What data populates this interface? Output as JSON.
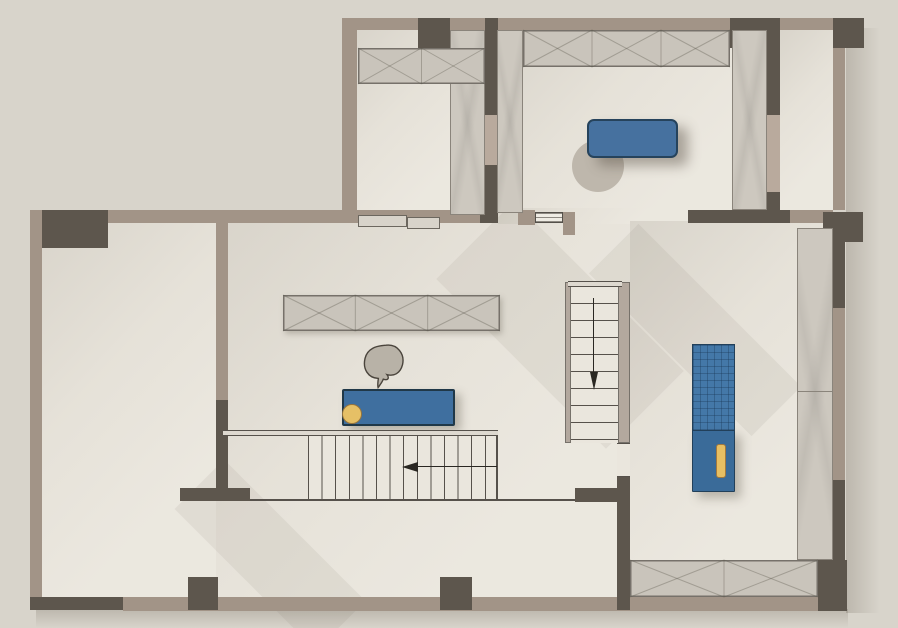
{
  "scene": {
    "kind": "architectural-floor-plan",
    "width": 898,
    "height": 628
  },
  "palette": {
    "bg": "#d8d4cb",
    "floor": "#eae6dd",
    "floorGrad": "linear-gradient(133deg, rgba(92,84,71,0.12), rgba(92,84,71,0.03) 38%, rgba(255,255,255,0.07) 75%)",
    "wallTan": "#a29487",
    "wallTanLight": "#b9aa9d",
    "wallDark": "#5d564d",
    "cabGray": "#c9c4bb",
    "cabBorder": "#76716a",
    "grainGray": "#cdc8bf",
    "grainBorder": "#8a847b",
    "railGray": "#b3a89e",
    "line": "#56514b",
    "xline": "rgba(90,85,75,0.35)",
    "bedBlue": "#46719f",
    "deskBlue": "#3f6f9f",
    "beltBlue": "#4478a8",
    "consoleBlue": "#3a6b99",
    "blueBorder": "#22405a",
    "stoolYellow": "#e6c066",
    "stoolBorder": "#97743c",
    "chairGray": "#b8b2a7",
    "chairBorder": "#4a443c",
    "shadowSoft": "rgba(100,90,76,0.08)",
    "outerShadow": "rgba(105,96,83,0.25)"
  },
  "elements": [
    {
      "name": "outer-shadow-right",
      "type": "shadegrad",
      "x": 846,
      "y": 28,
      "w": 34,
      "h": 585,
      "dir": "to right",
      "inter": false
    },
    {
      "name": "outer-shadow-bottom",
      "type": "shadegrad",
      "x": 36,
      "y": 609,
      "w": 812,
      "h": 19,
      "dir": "to bottom",
      "inter": false
    },
    {
      "name": "floor-cloakroom",
      "type": "floor",
      "x": 357,
      "y": 28,
      "w": 128,
      "h": 184,
      "inter": false
    },
    {
      "name": "floor-bedroom",
      "type": "floor",
      "x": 498,
      "y": 30,
      "w": 269,
      "h": 182,
      "inter": false
    },
    {
      "name": "floor-balcony",
      "type": "floor",
      "x": 780,
      "y": 30,
      "w": 53,
      "h": 182,
      "inter": false
    },
    {
      "name": "floor-left-room",
      "type": "floor",
      "x": 42,
      "y": 221,
      "w": 174,
      "h": 377,
      "inter": false
    },
    {
      "name": "floor-living-area",
      "type": "floor",
      "x": 216,
      "y": 223,
      "w": 414,
      "h": 374,
      "inter": false
    },
    {
      "name": "floor-hall-opening",
      "type": "floor",
      "x": 498,
      "y": 208,
      "w": 190,
      "h": 16,
      "inter": false
    },
    {
      "name": "floor-gym",
      "type": "floor",
      "x": 630,
      "y": 221,
      "w": 203,
      "h": 339,
      "inter": false
    },
    {
      "name": "light-shadow-hall",
      "type": "shade",
      "x": 505,
      "y": 205,
      "w": 110,
      "h": 240,
      "rot": -45,
      "inter": false
    },
    {
      "name": "light-shadow-gym",
      "type": "shade",
      "x": 660,
      "y": 215,
      "w": 70,
      "h": 230,
      "rot": -45,
      "inter": false
    },
    {
      "name": "light-shadow-foyer",
      "type": "shade",
      "x": 235,
      "y": 455,
      "w": 70,
      "h": 200,
      "rot": -45,
      "inter": false
    },
    {
      "name": "wall-top-upper",
      "type": "wall",
      "x": 347,
      "y": 18,
      "w": 488,
      "h": 12,
      "fill": "tan",
      "inter": false
    },
    {
      "name": "wall-upper-left",
      "type": "wall",
      "x": 342,
      "y": 18,
      "w": 15,
      "h": 197,
      "fill": "tan",
      "inter": false
    },
    {
      "name": "column-cloak-top",
      "type": "wall",
      "x": 418,
      "y": 18,
      "w": 32,
      "h": 30,
      "fill": "dark",
      "inter": false
    },
    {
      "name": "wall-cloak-bedroom-upper",
      "type": "wall",
      "x": 485,
      "y": 18,
      "w": 13,
      "h": 97,
      "fill": "dark",
      "inter": false
    },
    {
      "name": "door-cloak-bedroom",
      "type": "wall",
      "x": 485,
      "y": 115,
      "w": 13,
      "h": 50,
      "fill": "tanlight",
      "inter": true
    },
    {
      "name": "wall-cloak-bedroom-lower",
      "type": "wall",
      "x": 485,
      "y": 165,
      "w": 13,
      "h": 53,
      "fill": "dark",
      "inter": false
    },
    {
      "name": "column-bedroom-top",
      "type": "wall",
      "x": 730,
      "y": 18,
      "w": 50,
      "h": 30,
      "fill": "dark",
      "inter": false
    },
    {
      "name": "column-corner-ne",
      "type": "wall",
      "x": 833,
      "y": 18,
      "w": 31,
      "h": 30,
      "fill": "dark",
      "inter": false
    },
    {
      "name": "wall-right-upper",
      "type": "wall",
      "x": 833,
      "y": 48,
      "w": 12,
      "h": 162,
      "fill": "tan",
      "inter": false
    },
    {
      "name": "wall-bedroom-balcony-upper",
      "type": "wall",
      "x": 767,
      "y": 48,
      "w": 13,
      "h": 67,
      "fill": "dark",
      "inter": false
    },
    {
      "name": "door-bedroom-balcony",
      "type": "wall",
      "x": 767,
      "y": 115,
      "w": 13,
      "h": 77,
      "fill": "tanlight",
      "inter": true
    },
    {
      "name": "wall-bedroom-balcony-lower",
      "type": "wall",
      "x": 767,
      "y": 192,
      "w": 13,
      "h": 20,
      "fill": "dark",
      "inter": false
    },
    {
      "name": "wall-bedroom-bottom-dark",
      "type": "wall",
      "x": 688,
      "y": 210,
      "w": 102,
      "h": 13,
      "fill": "dark",
      "inter": false
    },
    {
      "name": "wall-bedroom-bottom-tan",
      "type": "wall",
      "x": 790,
      "y": 210,
      "w": 43,
      "h": 13,
      "fill": "tan",
      "inter": false
    },
    {
      "name": "column-corner-e",
      "type": "wall",
      "x": 823,
      "y": 212,
      "w": 40,
      "h": 30,
      "fill": "dark",
      "inter": false
    },
    {
      "name": "wall-right-mid-dark",
      "type": "wall",
      "x": 833,
      "y": 242,
      "w": 12,
      "h": 66,
      "fill": "dark",
      "inter": false
    },
    {
      "name": "wall-right-mid-tan",
      "type": "wall",
      "x": 833,
      "y": 308,
      "w": 12,
      "h": 172,
      "fill": "tan",
      "inter": false
    },
    {
      "name": "wall-right-low-dark",
      "type": "wall",
      "x": 833,
      "y": 480,
      "w": 12,
      "h": 131,
      "fill": "dark",
      "inter": false
    },
    {
      "name": "wall-top-lower",
      "type": "wall",
      "x": 30,
      "y": 210,
      "w": 317,
      "h": 13,
      "fill": "tan",
      "inter": false
    },
    {
      "name": "column-corner-nw",
      "type": "wall",
      "x": 30,
      "y": 210,
      "w": 78,
      "h": 38,
      "fill": "dark",
      "inter": false
    },
    {
      "name": "wall-left",
      "type": "wall",
      "x": 30,
      "y": 210,
      "w": 12,
      "h": 400,
      "fill": "tan",
      "inter": false
    },
    {
      "name": "wall-bottom-dark",
      "type": "wall",
      "x": 30,
      "y": 597,
      "w": 93,
      "h": 13,
      "fill": "dark",
      "inter": false
    },
    {
      "name": "wall-bottom-tan",
      "type": "wall",
      "x": 123,
      "y": 597,
      "w": 695,
      "h": 14,
      "fill": "tan",
      "inter": false
    },
    {
      "name": "column-bottom-a",
      "type": "wall",
      "x": 188,
      "y": 577,
      "w": 30,
      "h": 33,
      "fill": "dark",
      "inter": false
    },
    {
      "name": "column-bottom-b",
      "type": "wall",
      "x": 440,
      "y": 577,
      "w": 32,
      "h": 33,
      "fill": "dark",
      "inter": false
    },
    {
      "name": "column-corner-se",
      "type": "wall",
      "x": 818,
      "y": 560,
      "w": 29,
      "h": 51,
      "fill": "dark",
      "inter": false
    },
    {
      "name": "wall-interior-left-tan",
      "type": "wall",
      "x": 216,
      "y": 223,
      "w": 12,
      "h": 177,
      "fill": "tan",
      "inter": false
    },
    {
      "name": "wall-interior-left-dark",
      "type": "wall",
      "x": 216,
      "y": 400,
      "w": 12,
      "h": 88,
      "fill": "dark",
      "inter": false
    },
    {
      "name": "wall-tee-bar",
      "type": "wall",
      "x": 180,
      "y": 488,
      "w": 70,
      "h": 13,
      "fill": "dark",
      "inter": false
    },
    {
      "name": "wall-cloak-bottom",
      "type": "wall",
      "x": 342,
      "y": 210,
      "w": 156,
      "h": 13,
      "fill": "tan",
      "inter": false
    },
    {
      "name": "block-cloak-bottom-dark",
      "type": "wall",
      "x": 480,
      "y": 210,
      "w": 18,
      "h": 13,
      "fill": "dark",
      "inter": false
    },
    {
      "name": "jamb-bedroom-door-left",
      "type": "wall",
      "x": 518,
      "y": 210,
      "w": 17,
      "h": 15,
      "fill": "tan",
      "inter": false
    },
    {
      "name": "door-bedroom-leaf",
      "type": "door",
      "x": 535,
      "y": 212,
      "w": 28,
      "h": 11,
      "inter": true
    },
    {
      "name": "jamb-bedroom-door-right",
      "type": "wall",
      "x": 563,
      "y": 212,
      "w": 12,
      "h": 23,
      "fill": "tan",
      "inter": false
    },
    {
      "name": "wall-stairwell-low-dark",
      "type": "wall",
      "x": 617,
      "y": 477,
      "w": 13,
      "h": 133,
      "fill": "dark",
      "inter": false
    },
    {
      "name": "wall-stairwell-bar-dark",
      "type": "wall",
      "x": 575,
      "y": 488,
      "w": 55,
      "h": 14,
      "fill": "dark",
      "inter": false
    },
    {
      "name": "cabinet-cloak-vertical",
      "type": "grain",
      "x": 450,
      "y": 30,
      "w": 35,
      "h": 185,
      "inter": true
    },
    {
      "name": "cabinet-cloak-top",
      "type": "xcab",
      "x": 358,
      "y": 48,
      "w": 127,
      "h": 36,
      "seg": 2,
      "inter": true
    },
    {
      "name": "sliding-panel-a",
      "type": "panel",
      "x": 358,
      "y": 215,
      "w": 49,
      "h": 12,
      "inter": true
    },
    {
      "name": "sliding-panel-b",
      "type": "panel",
      "x": 407,
      "y": 217,
      "w": 33,
      "h": 12,
      "inter": true
    },
    {
      "name": "cabinet-bedroom-left",
      "type": "grain",
      "x": 497,
      "y": 30,
      "w": 26,
      "h": 183,
      "inter": true
    },
    {
      "name": "cabinet-bedroom-top",
      "type": "xcab",
      "x": 523,
      "y": 30,
      "w": 207,
      "h": 37,
      "seg": 3,
      "inter": true
    },
    {
      "name": "wardrobe-bedroom-right",
      "type": "grain",
      "x": 732,
      "y": 30,
      "w": 35,
      "h": 180,
      "inter": true
    },
    {
      "name": "rug-circle",
      "type": "circle",
      "x": 572,
      "y": 140,
      "w": 52,
      "h": 52,
      "fill": "#beb7ac",
      "inter": false
    },
    {
      "name": "bed",
      "type": "rect",
      "x": 587,
      "y": 119,
      "w": 91,
      "h": 39,
      "fill": "#46719f",
      "stroke": "#26435c",
      "sw": 2,
      "rad": 7,
      "shadow": "10px 8px 12px rgba(90,82,70,0.45)",
      "inter": true
    },
    {
      "name": "cabinet-living",
      "type": "xcab",
      "x": 283,
      "y": 295,
      "w": 217,
      "h": 36,
      "seg": 3,
      "shadow": "4px 4px 6px rgba(90,82,70,0.30)",
      "inter": true
    },
    {
      "name": "desk-chair",
      "type": "chair",
      "x": 358,
      "y": 341,
      "w": 50,
      "h": 52,
      "rot": 8,
      "inter": true
    },
    {
      "name": "desk",
      "type": "rect",
      "x": 342,
      "y": 389,
      "w": 113,
      "h": 37,
      "fill": "#3f6f9f",
      "stroke": "#203848",
      "sw": 2,
      "rad": 2,
      "shadow": "6px 5px 9px rgba(90,82,70,0.35)",
      "inter": true
    },
    {
      "name": "stool",
      "type": "circle",
      "x": 342,
      "y": 404,
      "w": 20,
      "h": 20,
      "fill": "#e6c066",
      "stroke": "#97743c",
      "sw": 1,
      "inter": true
    },
    {
      "name": "stair-rail-top",
      "type": "rail",
      "x": 223,
      "y": 430,
      "w": 275,
      "h": 6,
      "inter": false
    },
    {
      "name": "staircase-lower",
      "type": "stairs",
      "x": 308,
      "y": 436,
      "w": 190,
      "h": 63,
      "dir": "to right",
      "step": 13.6,
      "inter": true
    },
    {
      "name": "stair-edge-right",
      "type": "lineblock",
      "x": 496,
      "y": 436,
      "w": 2,
      "h": 63,
      "inter": false
    },
    {
      "name": "stair-bottom-line",
      "type": "lineblock",
      "x": 250,
      "y": 499,
      "w": 325,
      "h": 2,
      "inter": false
    },
    {
      "name": "stair-arrow-left",
      "type": "arrow",
      "x": 402,
      "y": 460,
      "w": 95,
      "h": 13,
      "dirn": "left",
      "inter": false
    },
    {
      "name": "stair-left-rail-upper",
      "type": "railv",
      "x": 565,
      "y": 282,
      "w": 6,
      "h": 161,
      "inter": false
    },
    {
      "name": "staircase-upper",
      "type": "stairs",
      "x": 571,
      "y": 286,
      "w": 47,
      "h": 157,
      "dir": "to bottom",
      "step": 17,
      "inter": true
    },
    {
      "name": "stair-wall-right-upper",
      "type": "railv",
      "x": 618,
      "y": 282,
      "w": 12,
      "h": 161,
      "inter": false
    },
    {
      "name": "stair-rail-top-upper",
      "type": "rail",
      "x": 568,
      "y": 281,
      "w": 54,
      "h": 6,
      "inter": false
    },
    {
      "name": "stair-arrow-down",
      "type": "arrow",
      "x": 587,
      "y": 298,
      "w": 13,
      "h": 92,
      "dirn": "down",
      "inter": false
    },
    {
      "name": "stair-opening-below",
      "type": "opening",
      "x": 617,
      "y": 443,
      "w": 13,
      "h": 34,
      "inter": false
    },
    {
      "name": "treadmill-belt",
      "type": "grid",
      "x": 692,
      "y": 344,
      "w": 43,
      "h": 88,
      "inter": true
    },
    {
      "name": "treadmill-console",
      "type": "rect",
      "x": 692,
      "y": 430,
      "w": 43,
      "h": 62,
      "fill": "#3a6b99",
      "stroke": "#22405a",
      "sw": 1.5,
      "rad": 1,
      "shadow": "6px 6px 10px rgba(90,82,70,0.35)",
      "inter": true
    },
    {
      "name": "treadmill-handle",
      "type": "rect",
      "x": 716,
      "y": 444,
      "w": 10,
      "h": 34,
      "fill": "#e7bf63",
      "stroke": "#a3793d",
      "sw": 1,
      "rad": 3,
      "inter": false
    },
    {
      "name": "cabinet-gym-right",
      "type": "grain",
      "x": 797,
      "y": 228,
      "w": 36,
      "h": 332,
      "divs": [
        162
      ],
      "inter": true
    },
    {
      "name": "cabinet-gym-bottom",
      "type": "xcab",
      "x": 630,
      "y": 560,
      "w": 188,
      "h": 37,
      "seg": 2,
      "inter": true
    }
  ]
}
